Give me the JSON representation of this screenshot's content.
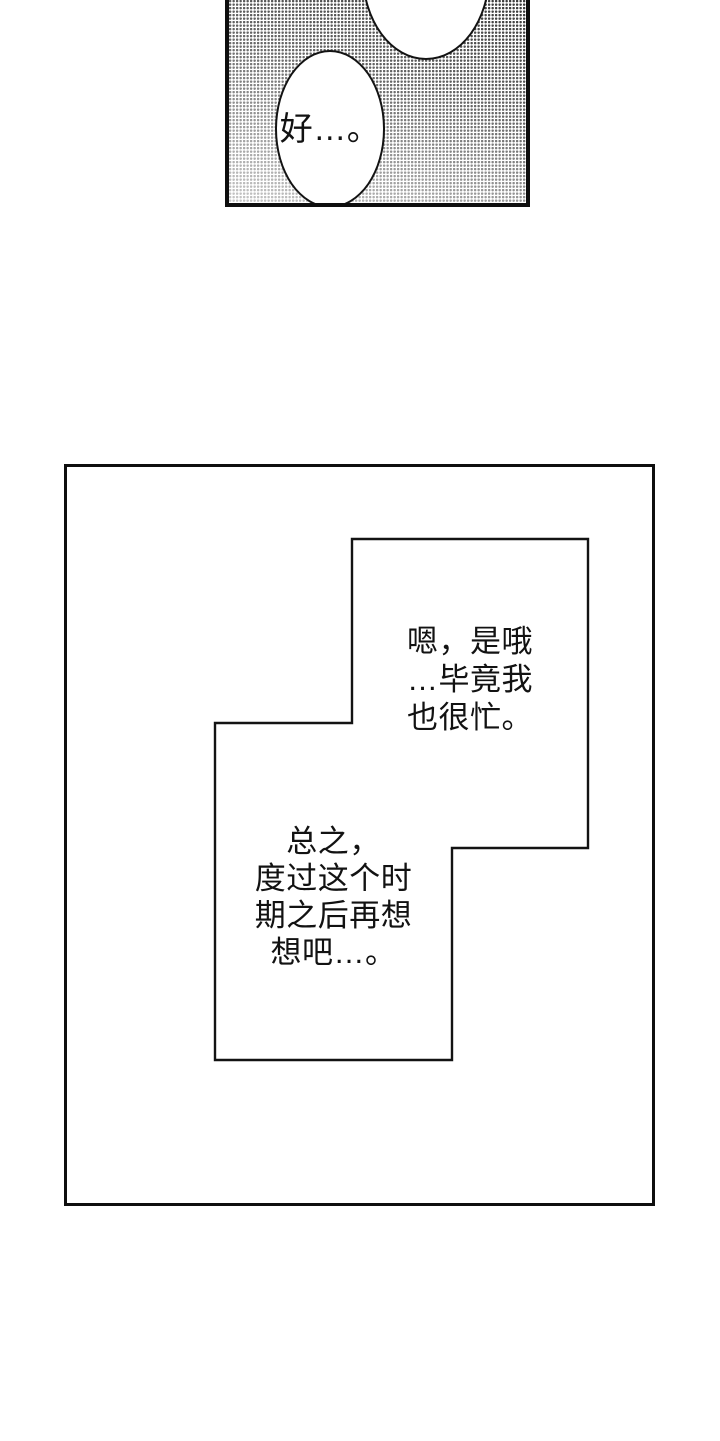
{
  "colors": {
    "ink": "#121212",
    "paper": "#ffffff",
    "halftone_dot": "#3a3a3a"
  },
  "panel_top": {
    "description": "halftone-shaded manga panel cropped by page top",
    "bubble_text": "好…。"
  },
  "panel_main": {
    "bubble1_lines": [
      "嗯，是哦",
      "…毕竟我",
      "也很忙。"
    ],
    "bubble2_lines": [
      "总之，",
      "度过这个时",
      "期之后再想",
      "想吧…。"
    ]
  }
}
